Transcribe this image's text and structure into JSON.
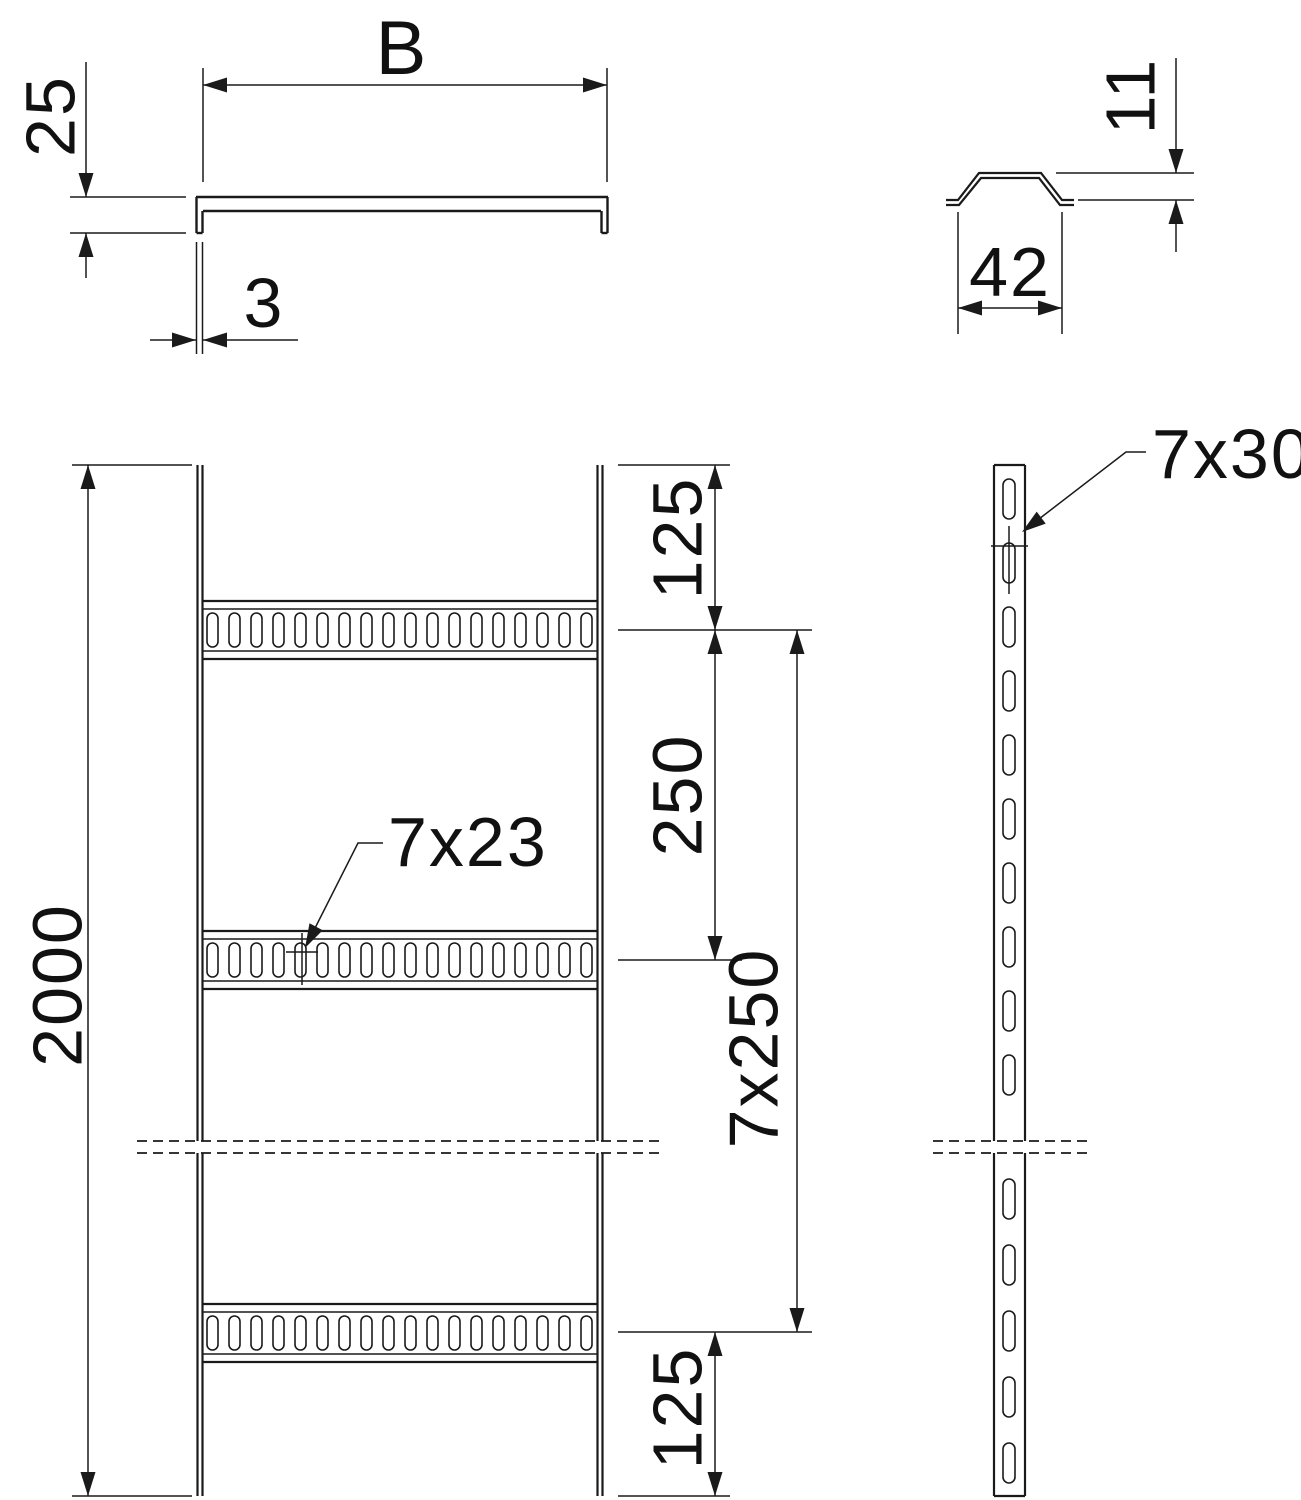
{
  "drawing": {
    "kind": "cable-ladder technical drawing, four orthographic views",
    "labels": {
      "section_width": "B",
      "section_height": "25",
      "section_thickness": "3",
      "profile_height": "11",
      "profile_width": "42",
      "overall_length": "2000",
      "end_spacing_top": "125",
      "rung_pitch": "250",
      "rung_pitch_total": "7x250",
      "end_spacing_bottom": "125",
      "rung_slot_callout": "7x23",
      "rail_slot_callout": "7x30"
    },
    "geometry": {
      "front_view": {
        "rung_count": 3,
        "slots_per_rung": 18
      },
      "side_view": {
        "slots_above_break": 10,
        "slots_below_break": 5
      }
    },
    "colors": {
      "line": "#1a1a1a",
      "background": "#ffffff"
    }
  }
}
